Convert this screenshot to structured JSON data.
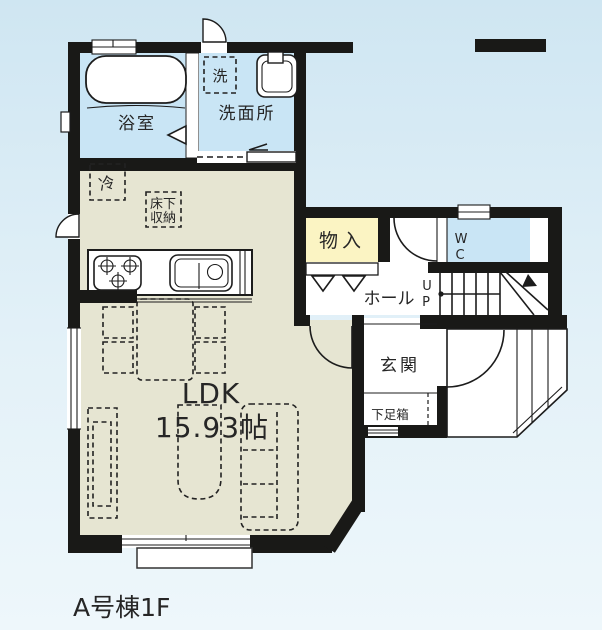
{
  "title": "A号棟1F",
  "colors": {
    "wall": "#191917",
    "room_blue": "#c9e5f5",
    "room_beige": "#e6e5d2",
    "room_yellow": "#fbf4c3",
    "bg_top": "#cfe6f2",
    "bg_bottom": "#eef7fb"
  },
  "rooms": {
    "bathroom": {
      "label": "浴室"
    },
    "washroom": {
      "label": "洗面所"
    },
    "washer": {
      "label": "洗"
    },
    "fridge": {
      "label": "冷"
    },
    "underfloor_storage": {
      "line1": "床下",
      "line2": "収納"
    },
    "closet": {
      "label": "物入"
    },
    "wc": {
      "line1": "W",
      "line2": "C"
    },
    "hall": {
      "label": "ホール"
    },
    "stairs": {
      "line1": "U",
      "line2": "P"
    },
    "entrance": {
      "label": "玄関"
    },
    "shoe_box": {
      "label": "下足箱"
    },
    "ldk": {
      "label": "LDK",
      "area": "15.93帖"
    }
  }
}
